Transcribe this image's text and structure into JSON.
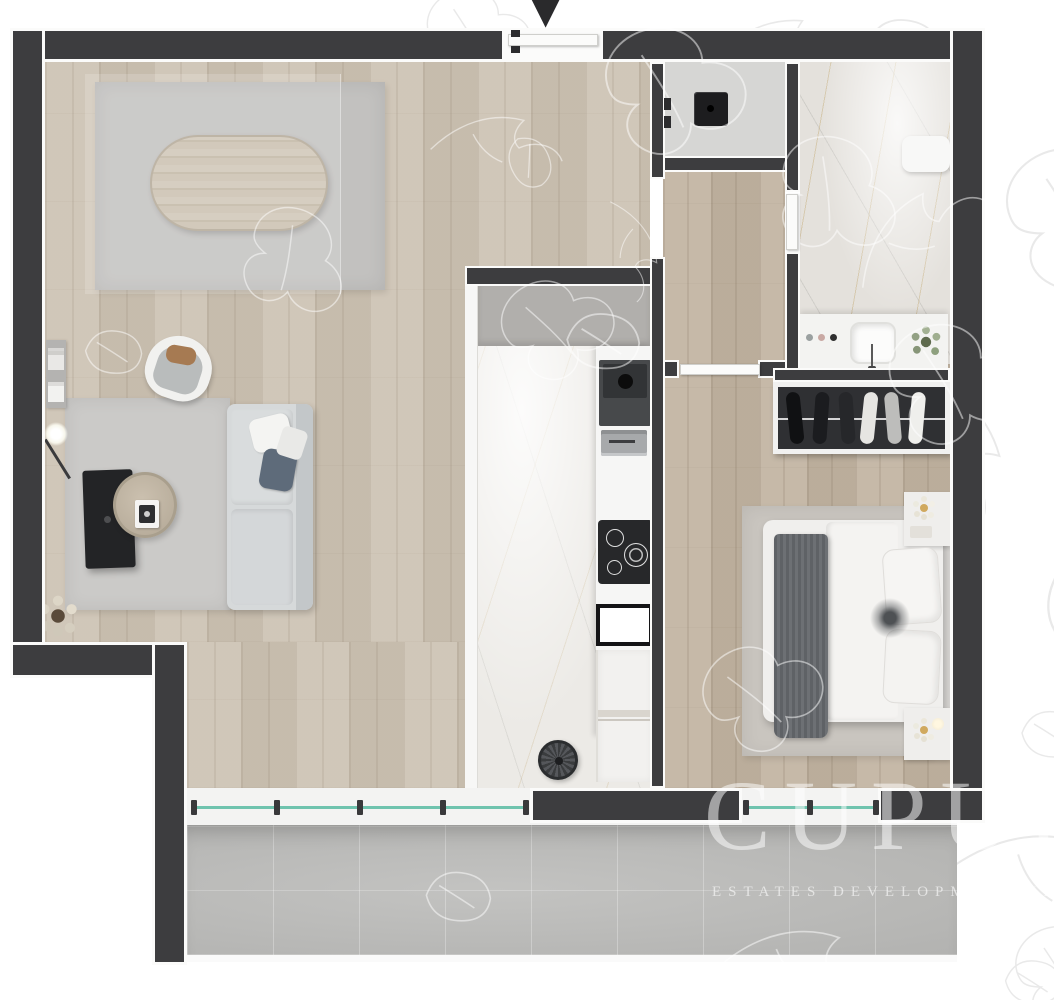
{
  "watermark": {
    "title": "CUPUI",
    "subtitle": "ESTATES DEVELOPMENT IN"
  },
  "icons": {
    "entry_arrow": "▼"
  },
  "palette": {
    "wall": "#3d3d3f",
    "wood": "#cdc3b4",
    "wood_dark": "#c2b5a3",
    "marble": "#eceae6",
    "marble_bath": "#e4e1dc",
    "concrete": "#bcbcba",
    "glass": "#6fc3ae",
    "rug": "#cbcac8",
    "watermark": "rgba(255,255,255,0.52)"
  }
}
